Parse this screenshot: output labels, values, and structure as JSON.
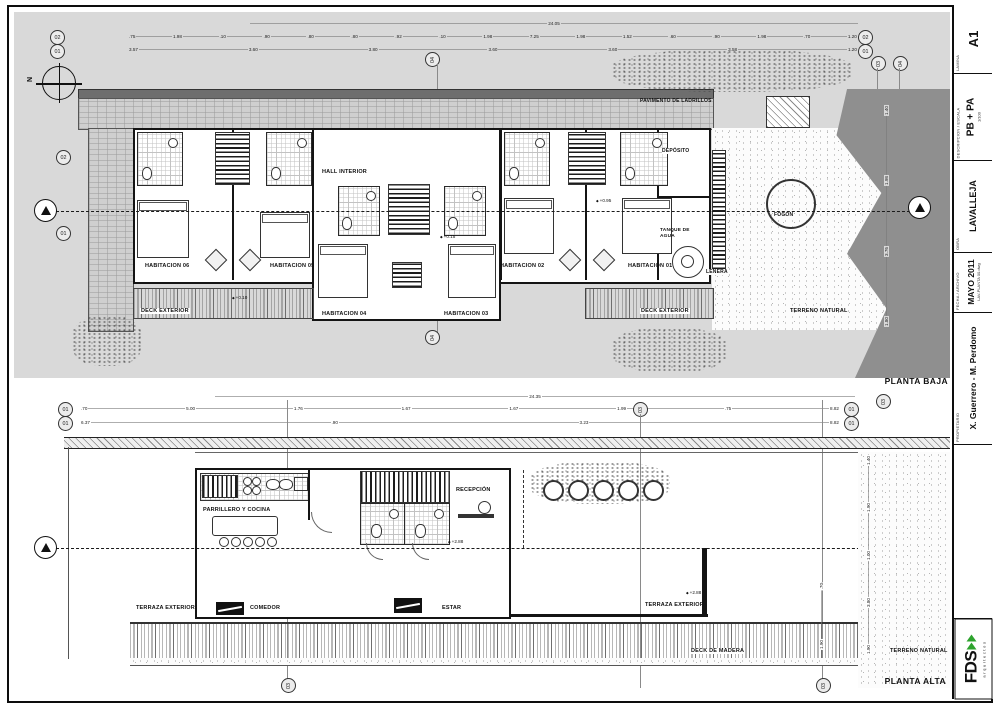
{
  "colors": {
    "paper": "#ffffff",
    "field_gray": "#d9d9d9",
    "terrain_dark": "#8f8f8f",
    "line": "#111111",
    "logo_green": "#2ea32e"
  },
  "sheet": {
    "north": "N"
  },
  "title_block": {
    "lamina_header": "LAMINA",
    "lamina": "A1",
    "descripcion_header": "DESCRIPCION / ESCALA",
    "descripcion": "PB + PA",
    "escala": "1/100",
    "obra_header": "OBRA",
    "obra": "LAVALLEJA",
    "fecha_header": "FECHA / ARCHIVO",
    "fecha": "MAYO 2011",
    "archivo": "LAV-PLANTA 00.dwg",
    "propietario_header": "PROPIETARIO",
    "propietario": "X. Guerrero - M. Perdomo",
    "logo_text": "FDS",
    "logo_sub": "arquitectos"
  },
  "upper_plan": {
    "title": "PLANTA BAJA",
    "labels": {
      "pavimento": "PAVIMENTO DE LADRILLOS",
      "hall": "HALL INTERIOR",
      "h06": "HABITACION 06",
      "h05": "HABITACION 05",
      "h04": "HABITACION 04",
      "h03": "HABITACION 03",
      "h02": "HABITACION 02",
      "h01": "HABITACION 01",
      "deck_left": "DECK EXTERIOR",
      "deck_right": "DECK EXTERIOR",
      "deposito": "DEPÓSITO",
      "tanque": "TANQUE DE AGUA",
      "lenera": "LEÑERA",
      "fogon": "FOGÓN",
      "terreno": "TERRENO NATURAL"
    },
    "levels": {
      "hall": "+0.15",
      "deck": "+0.10",
      "room": "+0.95"
    },
    "dims": {
      "total": "24.05",
      "row_a": [
        ".75",
        "1.98",
        ".10",
        ".90",
        ".80",
        ".80",
        ".92",
        ".10",
        "1.98",
        "7.25",
        "1.98",
        "1.52",
        ".60",
        ".90",
        "1.98",
        ".70",
        "1.20"
      ],
      "row_b": [
        "3.57",
        "3.60",
        "3.80",
        "3.60",
        "3.60",
        "3.58",
        "1.20"
      ],
      "right_col": [
        "1.40",
        "1.98",
        "3.76",
        "1.80"
      ]
    },
    "grid": {
      "l1": "02",
      "l2": "01",
      "lm1": "02",
      "lm2": "01",
      "r1": "02",
      "r2": "01",
      "rm1": "02",
      "rm2": "01",
      "top": "04",
      "bottom": "04",
      "rt1": "03",
      "rt2": "04"
    }
  },
  "lower_plan": {
    "title": "PLANTA ALTA",
    "labels": {
      "parrillero": "PARRILLERO Y COCINA",
      "recepcion": "RECEPCIÓN",
      "comedor": "COMEDOR",
      "estar": "ESTAR",
      "terraza_left": "TERRAZA EXTERIOR",
      "terraza_right": "TERRAZA EXTERIOR",
      "deck": "DECK DE MADERA",
      "terreno": "TERRENO NATURAL"
    },
    "levels": {
      "a": "+2.88",
      "b": "+2.88"
    },
    "dims": {
      "total": "24.35",
      "row_a": [
        ".70",
        "5.00",
        "1.76",
        "1.67",
        "1.67",
        "1.99",
        ".75",
        "8.82"
      ],
      "row_b": [
        "6.37",
        ".90",
        "3.23",
        "8.82"
      ],
      "right_col": [
        "1.40",
        "1.90",
        "1.00",
        "3.80",
        "1.90"
      ],
      "mid_col": [
        ".70",
        "1.90"
      ]
    },
    "grid": {
      "l1": "01",
      "l2": "01",
      "r1": "01",
      "r2": "01",
      "rr": "03",
      "mt": "03",
      "b1": "03",
      "b2": "03"
    }
  }
}
